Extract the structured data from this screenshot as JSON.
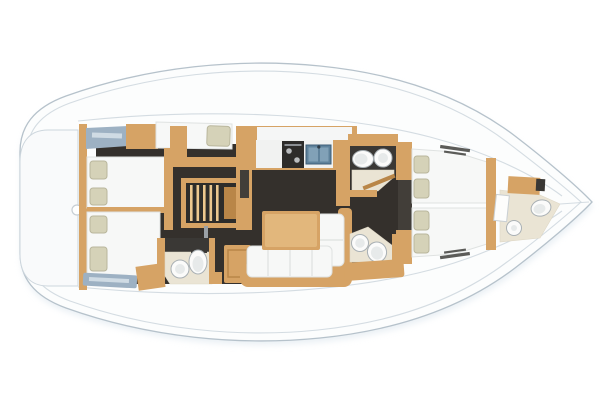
{
  "figure": {
    "type": "yacht-floor-plan",
    "view": "top-down",
    "bow_direction": "right",
    "description": "Sailing yacht interior layout plan, bow to the right"
  },
  "colors": {
    "hull_fill": "#fcfdfd",
    "hull_outline": "#b6c2cb",
    "shadow": "#d5e1ea",
    "deck_line": "#cdd6dd",
    "transom_fill": "#f9fafb",
    "wood": "#d6a365",
    "wood_dark": "#b98648",
    "wood_light": "#ecc88f",
    "floor_dark": "#34302c",
    "floor_dark2": "#423e39",
    "mattress": "#f7f8f7",
    "mattress_edge": "#dfe2e1",
    "pillow": "#d5d2b8",
    "pillow_edge": "#b9b69c",
    "bath_floor": "#eae4d4",
    "counter_dark": "#3a3835",
    "fixture_white": "#fbfbfa",
    "fixture_edge": "#a9b0b4",
    "panel_slate": "#9db1c3",
    "panel_slate_light": "#cfdbe4",
    "stove_dark": "#2d2c2a",
    "sink_blue": "#5f829b",
    "sink_blue_dark": "#3e5f78",
    "sink_blue_light": "#81a1b7"
  },
  "zones": {
    "stern": [
      "swim-platform",
      "transom-knob",
      "aft-bulkhead"
    ],
    "aft_cabins": [
      "port-aft-double-berth",
      "starboard-aft-double-berth",
      "pullman-berth",
      "hull-window-panel",
      "locker-panel"
    ],
    "companionway": [
      "stairs",
      "handrail",
      "cabinet"
    ],
    "galley": [
      "counter",
      "backsplash",
      "stove",
      "double-sink",
      "grab-rail"
    ],
    "saloon": [
      "dining-table",
      "settee-bench",
      "chaise-lounge",
      "settee-rim"
    ],
    "heads": [
      "aft-head",
      "starboard-forward-head",
      "port-forward-head",
      "bow-head"
    ],
    "head_fixtures": [
      "toilet",
      "round-sink",
      "shower-drain",
      "vanity"
    ],
    "forward_cabin": [
      "v-berth-starboard",
      "v-berth-port",
      "berth-pillows",
      "deck-hatches",
      "forward-bulkhead"
    ],
    "bow": [
      "locker-door",
      "bow-vanity",
      "bow-toilet",
      "bow-shower"
    ]
  }
}
